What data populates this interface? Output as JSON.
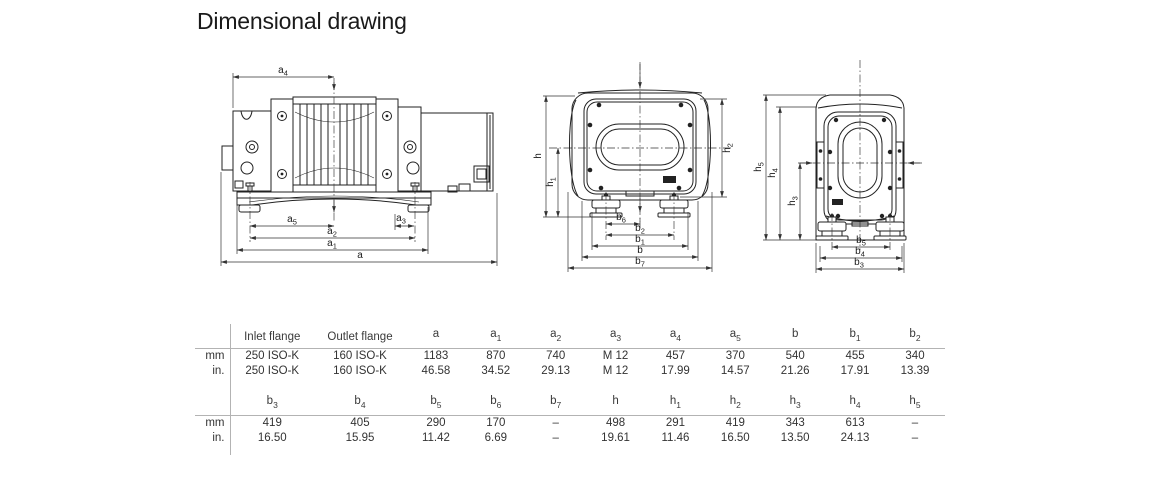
{
  "title": "Dimensional drawing",
  "dims": {
    "inlet_flange": {
      "b": "Inlet flange",
      "s": ""
    },
    "outlet_flange": {
      "b": "Outlet flange",
      "s": ""
    },
    "a": {
      "b": "a",
      "s": ""
    },
    "a1": {
      "b": "a",
      "s": "1"
    },
    "a2": {
      "b": "a",
      "s": "2"
    },
    "a3": {
      "b": "a",
      "s": "3"
    },
    "a4": {
      "b": "a",
      "s": "4"
    },
    "a5": {
      "b": "a",
      "s": "5"
    },
    "b": {
      "b": "b",
      "s": ""
    },
    "b1": {
      "b": "b",
      "s": "1"
    },
    "b2": {
      "b": "b",
      "s": "2"
    },
    "b3": {
      "b": "b",
      "s": "3"
    },
    "b4": {
      "b": "b",
      "s": "4"
    },
    "b5": {
      "b": "b",
      "s": "5"
    },
    "b6": {
      "b": "b",
      "s": "6"
    },
    "b7": {
      "b": "b",
      "s": "7"
    },
    "h": {
      "b": "h",
      "s": ""
    },
    "h1": {
      "b": "h",
      "s": "1"
    },
    "h2": {
      "b": "h",
      "s": "2"
    },
    "h3": {
      "b": "h",
      "s": "3"
    },
    "h4": {
      "b": "h",
      "s": "4"
    },
    "h5": {
      "b": "h",
      "s": "5"
    }
  },
  "table": {
    "unit_labels": [
      "mm",
      "in."
    ],
    "group1": {
      "mm": [
        "250 ISO-K",
        "160 ISO-K",
        "1183",
        "870",
        "740",
        "M 12",
        "457",
        "370",
        "540",
        "455",
        "340"
      ],
      "in": [
        "250 ISO-K",
        "160 ISO-K",
        "46.58",
        "34.52",
        "29.13",
        "M 12",
        "17.99",
        "14.57",
        "21.26",
        "17.91",
        "13.39"
      ]
    },
    "group2": {
      "mm": [
        "419",
        "405",
        "290",
        "170",
        "–",
        "498",
        "291",
        "419",
        "343",
        "613",
        "–"
      ],
      "in": [
        "16.50",
        "15.95",
        "11.42",
        "6.69",
        "–",
        "19.61",
        "11.46",
        "16.50",
        "13.50",
        "24.13",
        "–"
      ]
    }
  }
}
